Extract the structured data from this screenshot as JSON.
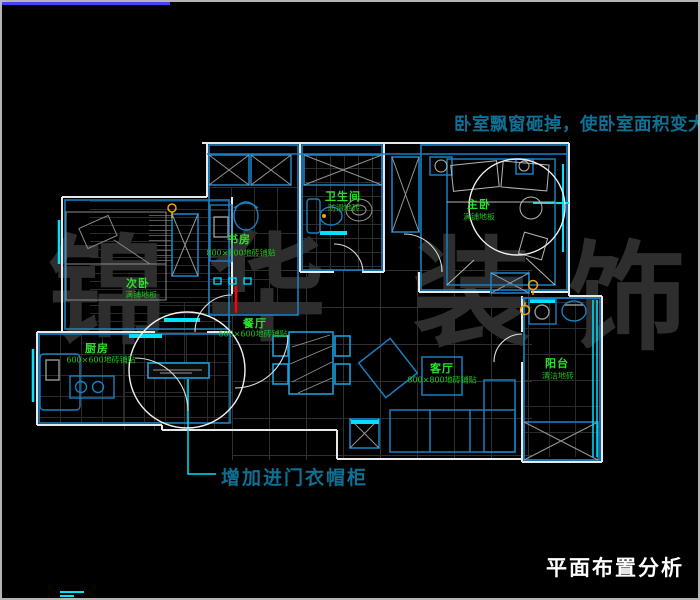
{
  "frame": {
    "background": "#000000",
    "border_color": "#b5b5b5",
    "top_line_color": "#4343ff"
  },
  "title": {
    "text": "平面布置分析",
    "color": "#ffffff"
  },
  "annotations": {
    "bay_window_note": "卧室飘窗砸掉，使卧室面积变大",
    "entry_note": "增加进门衣帽柜",
    "note_color": "#0e7093",
    "leader_color": "#00e0ff",
    "highlight_red_line": "#ff0000"
  },
  "watermark": {
    "text": "锦华装饰",
    "chars": [
      "锦",
      "华",
      "装",
      "饰"
    ],
    "color": "#2e2e2e"
  },
  "rooms": [
    {
      "name": "书房",
      "finish": "800×800地砖铺贴"
    },
    {
      "name": "卫生间",
      "finish": "防滑地砖"
    },
    {
      "name": "主卧",
      "finish": "满铺地板"
    },
    {
      "name": "次卧",
      "finish": "满铺地板"
    },
    {
      "name": "厨房",
      "finish": "600×600地砖铺贴"
    },
    {
      "name": "餐厅",
      "finish": "600×600地砖铺贴"
    },
    {
      "name": "客厅",
      "finish": "800×800地砖铺贴"
    },
    {
      "name": "阳台",
      "finish": "清洁地砖"
    }
  ],
  "colors": {
    "wall": "#e8e8e8",
    "room_line": "#1a7fc0",
    "window": "#00e0ff",
    "label": "#2be22b",
    "finish_label": "#1dc21d",
    "door_symbol": "#f0a500",
    "furniture_gray": "#969696"
  }
}
